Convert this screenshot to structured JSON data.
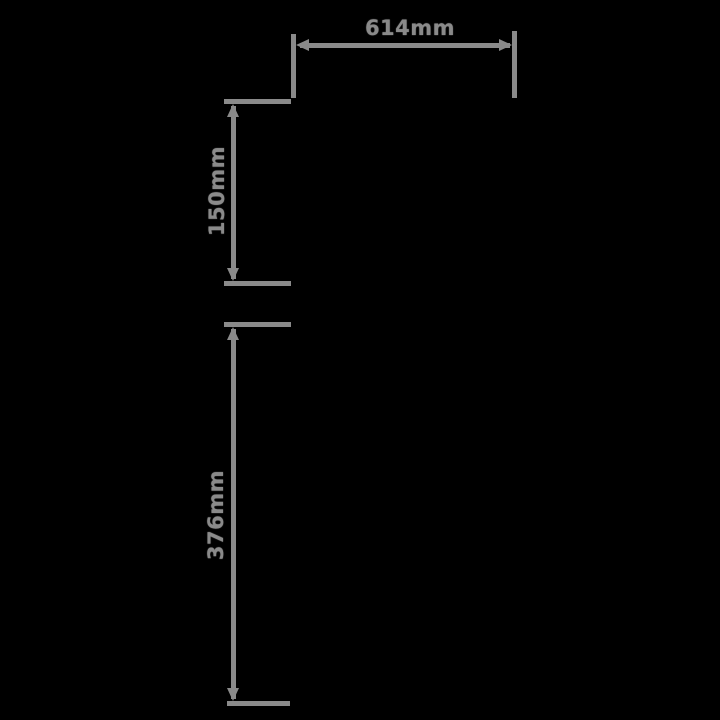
{
  "diagram": {
    "type": "technical-dimension-drawing",
    "background_color": "#000000",
    "line_color": "#8a8a8a",
    "unit": "mm",
    "width_dimension": {
      "label": "614mm",
      "orientation": "horizontal",
      "position": "top"
    },
    "upper_height_dimension": {
      "label": "150mm",
      "orientation": "vertical",
      "position": "upper-left"
    },
    "lower_height_dimension": {
      "label": "376mm",
      "orientation": "vertical",
      "position": "lower-left"
    }
  }
}
